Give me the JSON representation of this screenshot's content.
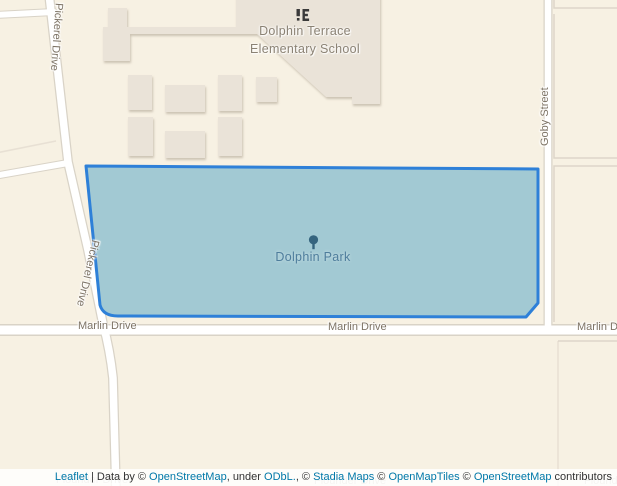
{
  "map": {
    "colors": {
      "background": "#f7f1e3",
      "building_fill": "#eae3d8",
      "road_fill": "#ffffff",
      "road_casing": "#d9d3c7",
      "parcel_line": "#ddd6c9",
      "park_fill": "#a2c9d3",
      "park_border": "#2e80d8",
      "park_label": "#4e7d9c",
      "tree_icon": "#35647e",
      "street_label": "#7d7365",
      "poi_label": "#8b8274",
      "school_icon": "#3a3a3a",
      "link": "#0078a8",
      "attribution_text": "#333333"
    },
    "pois": {
      "school": {
        "name_line1": "Dolphin Terrace",
        "name_line2": "Elementary School",
        "icon": "school-icon"
      },
      "park": {
        "name": "Dolphin Park",
        "icon": "tree-icon"
      }
    },
    "streets": {
      "pickerel_top": "Pickerel Drive",
      "pickerel_mid": "Pickerel Drive",
      "goby": "Goby Street",
      "marlin_left": "Marlin Drive",
      "marlin_center": "Marlin Drive",
      "marlin_right": "Marlin Drive",
      "flounder_left": "Flounder Drive",
      "flounder_center": "Flounder Drive",
      "flounder_right": "Flounder Drive"
    }
  },
  "attribution": {
    "segments": [
      {
        "text": "Leaflet",
        "link": true
      },
      {
        "text": " | Data by © ",
        "link": false
      },
      {
        "text": "OpenStreetMap",
        "link": true
      },
      {
        "text": ", under ",
        "link": false
      },
      {
        "text": "ODbL.",
        "link": true
      },
      {
        "text": ", © ",
        "link": false
      },
      {
        "text": "Stadia Maps",
        "link": true
      },
      {
        "text": " © ",
        "link": false
      },
      {
        "text": "OpenMapTiles",
        "link": true
      },
      {
        "text": " © ",
        "link": false
      },
      {
        "text": "OpenStreetMap",
        "link": true
      },
      {
        "text": " contributors",
        "link": false
      }
    ]
  }
}
